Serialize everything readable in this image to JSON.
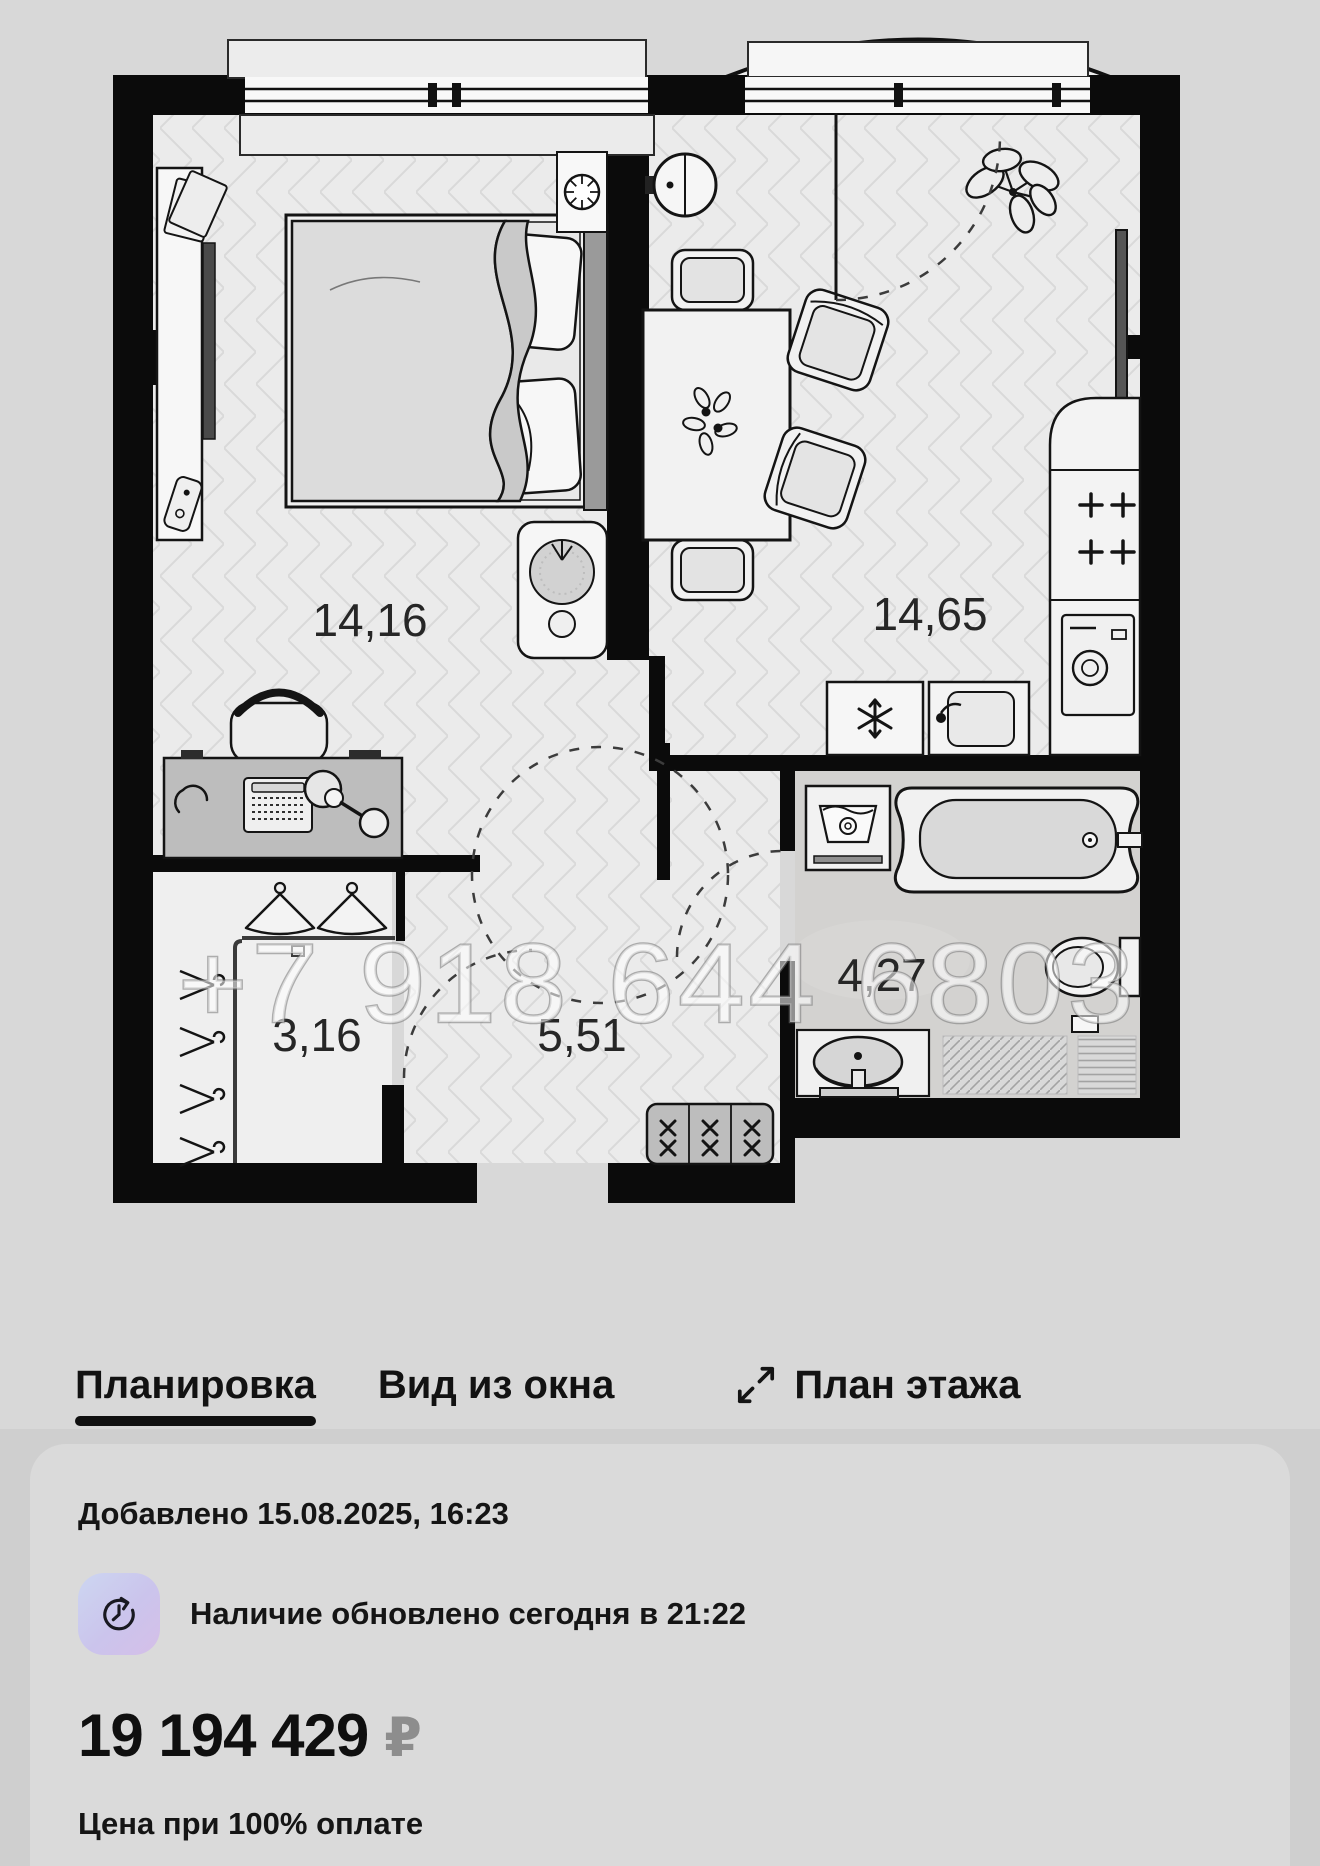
{
  "plan": {
    "watermark": "+7 918 644 6803",
    "areas": {
      "bedroom": "14,16",
      "living_kitchen": "14,65",
      "wardrobe": "3,16",
      "hallway": "5,51",
      "bathroom": "4,27"
    }
  },
  "tabs": {
    "layout": "Планировка",
    "window_view": "Вид из окна",
    "floor_plan": "План этажа"
  },
  "info_card": {
    "added": "Добавлено 15.08.2025, 16:23",
    "availability": "Наличие обновлено сегодня в 21:22",
    "price": "19 194 429",
    "currency": "₽",
    "price_note": "Цена при 100% оплате"
  },
  "colors": {
    "page_bg": "#d8d8d8",
    "card_bg": "#dadada",
    "wall": "#0b0b0b",
    "badge_gradient_from": "#ccd6f1",
    "badge_gradient_to": "#d5bfe8",
    "currency_gray": "#8d8d8d"
  }
}
